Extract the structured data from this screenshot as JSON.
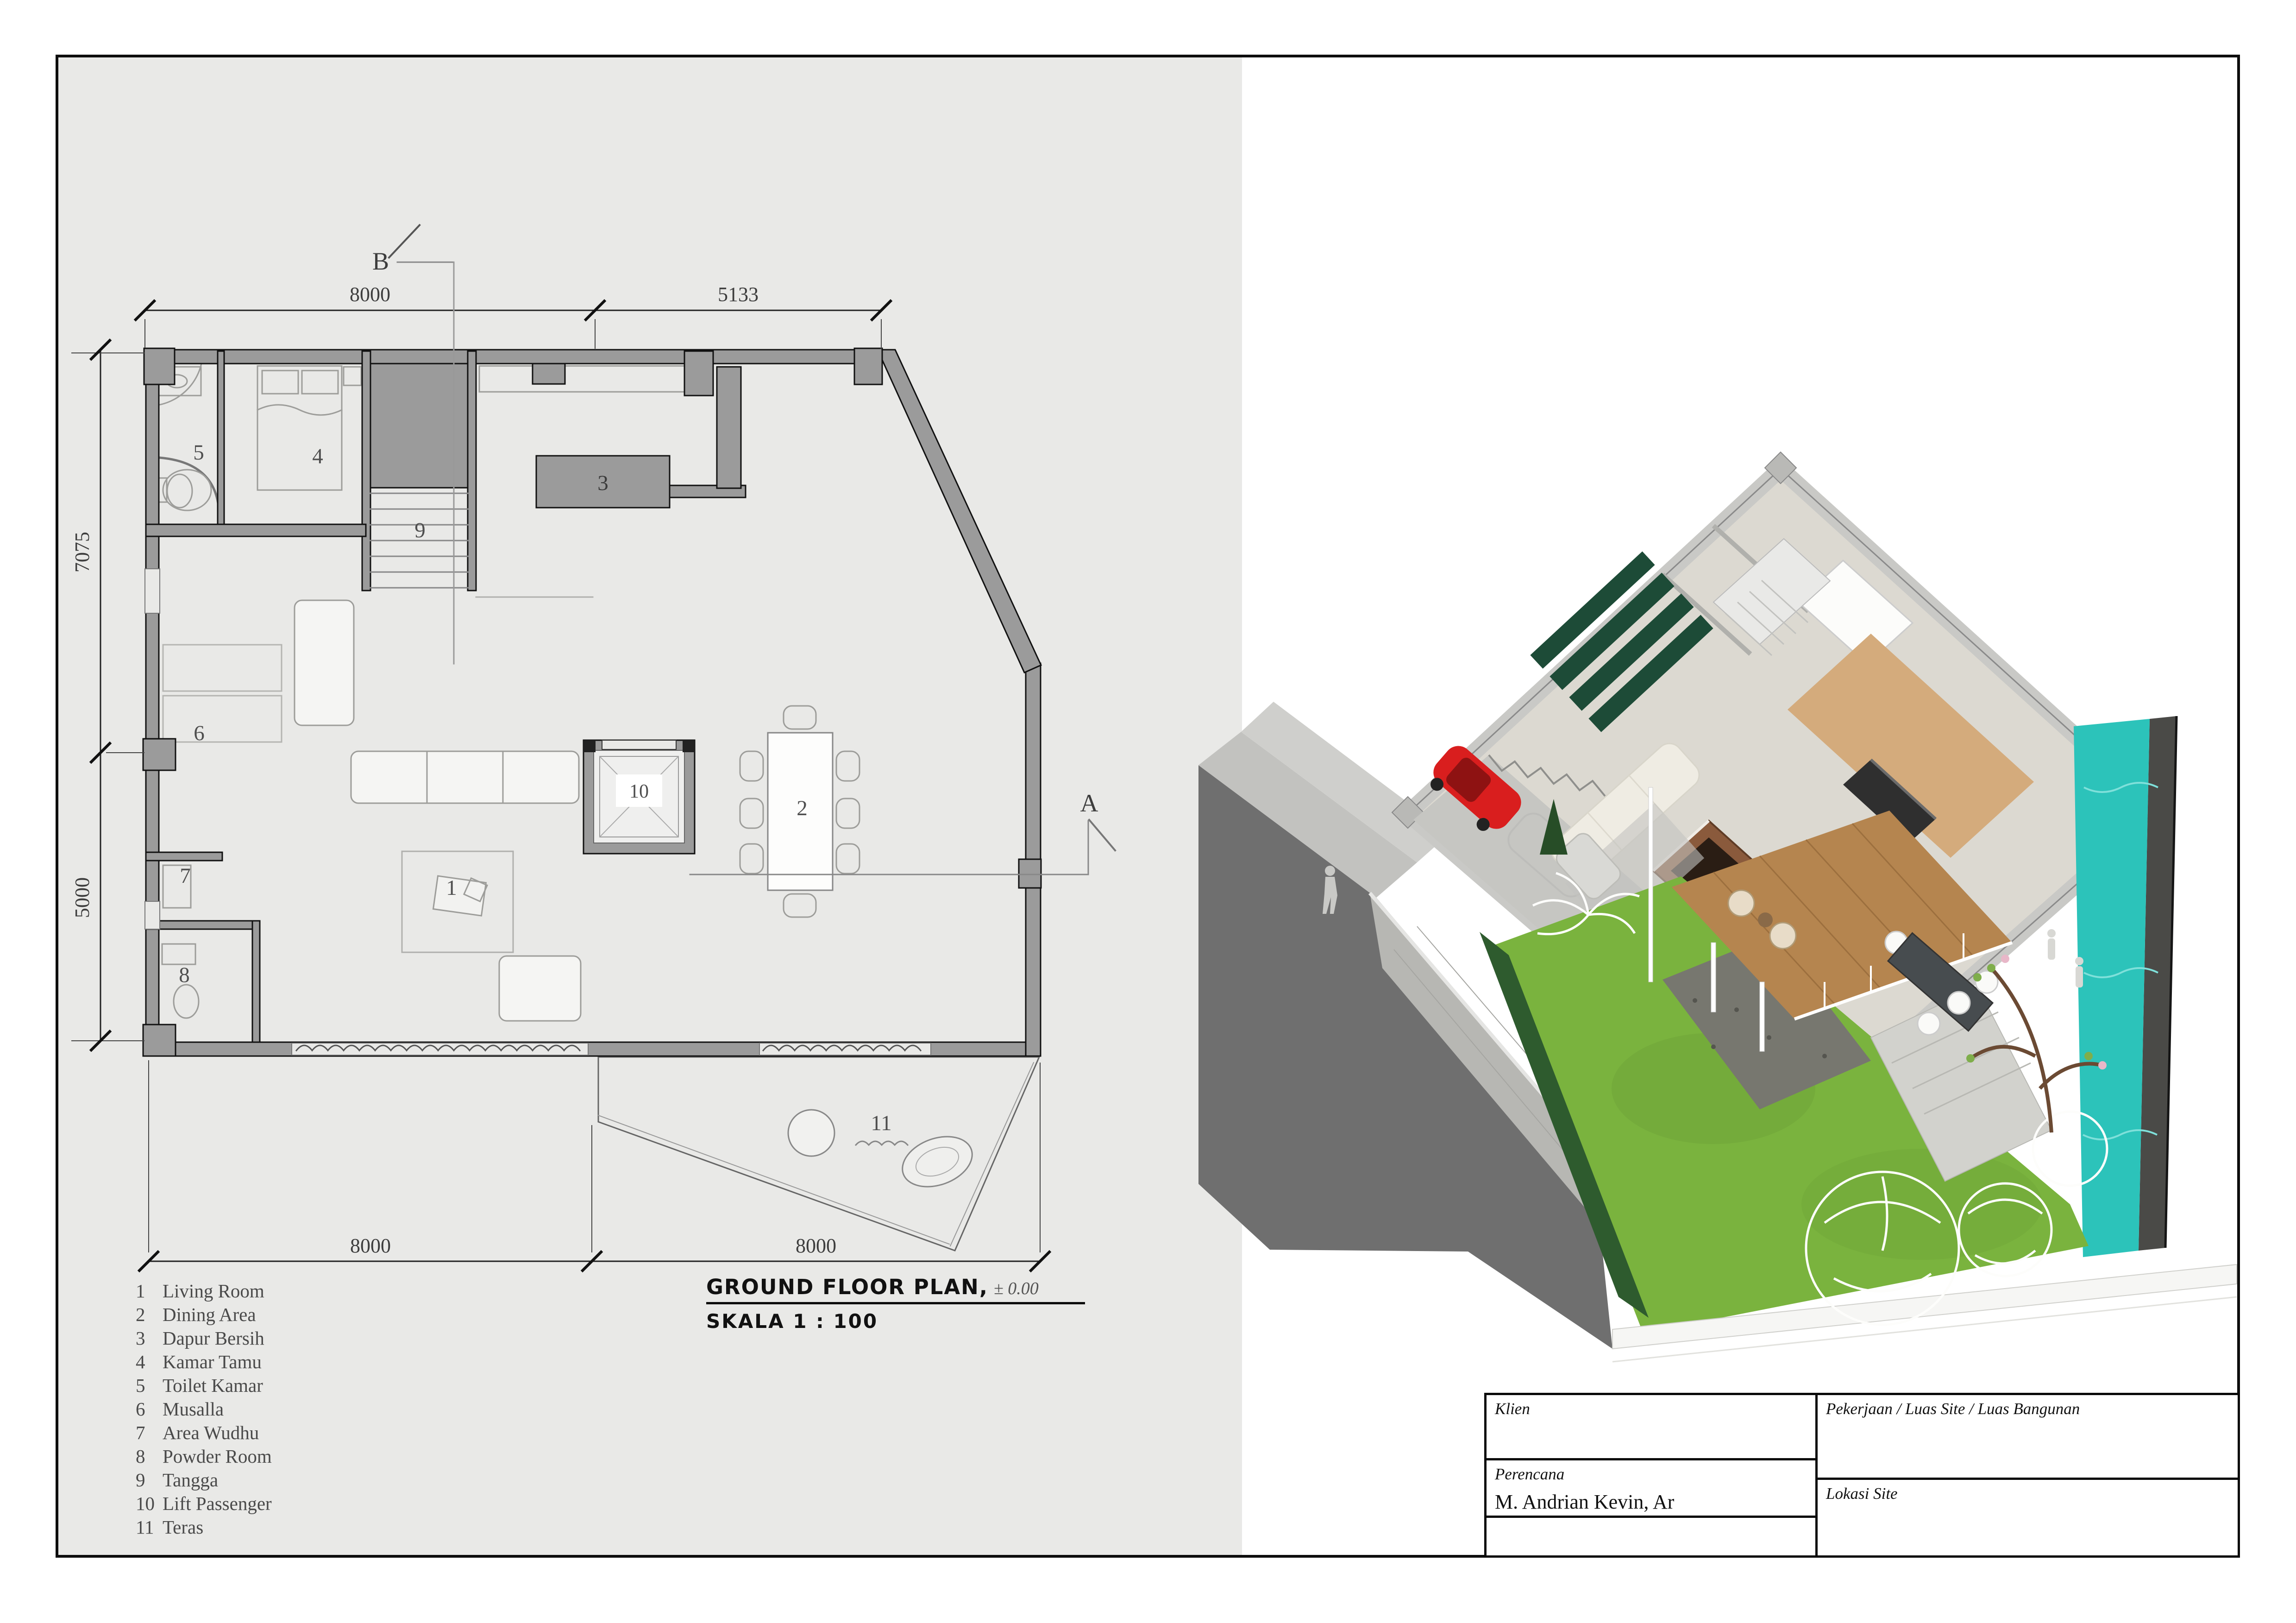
{
  "page": {
    "sheet_bg": "#e9e9e7",
    "frame_color": "#0d0d0d",
    "accent_colors": {
      "wall_gray": "#9b9b9b",
      "shadow_gray": "#6f6f6f",
      "grass_green": "#7ab33e",
      "pool_teal": "#2cc3ba",
      "car_red": "#d91e1e",
      "solar_green": "#1d4b37",
      "wood_brown": "#b5854f"
    }
  },
  "plan": {
    "dim_top": [
      "8000",
      "5133"
    ],
    "dim_left": [
      "7075",
      "5000"
    ],
    "dim_bottom": [
      "8000",
      "8000"
    ],
    "marker_b": "B",
    "marker_a": "A",
    "room_numbers": [
      "1",
      "2",
      "3",
      "4",
      "5",
      "6",
      "7",
      "8",
      "9",
      "10",
      "11"
    ]
  },
  "legend": {
    "items": [
      {
        "no": "1",
        "label": "Living Room"
      },
      {
        "no": "2",
        "label": "Dining Area"
      },
      {
        "no": "3",
        "label": "Dapur Bersih"
      },
      {
        "no": "4",
        "label": "Kamar Tamu"
      },
      {
        "no": "5",
        "label": "Toilet Kamar"
      },
      {
        "no": "6",
        "label": "Musalla"
      },
      {
        "no": "7",
        "label": "Area Wudhu"
      },
      {
        "no": "8",
        "label": "Powder Room"
      },
      {
        "no": "9",
        "label": "Tangga"
      },
      {
        "no": "10",
        "label": "Lift Passenger"
      },
      {
        "no": "11",
        "label": "Teras"
      }
    ]
  },
  "title": {
    "main": "GROUND FLOOR PLAN,",
    "elevation": "± 0.00",
    "scale": "SKALA 1 : 100"
  },
  "title_block": {
    "klien_label": "Klien",
    "pekerjaan_label": "Pekerjaan / Luas Site / Luas Bangunan",
    "perencana_label": "Perencana",
    "perencana_value": "M. Andrian Kevin, Ar",
    "lokasi_label": "Lokasi Site"
  }
}
